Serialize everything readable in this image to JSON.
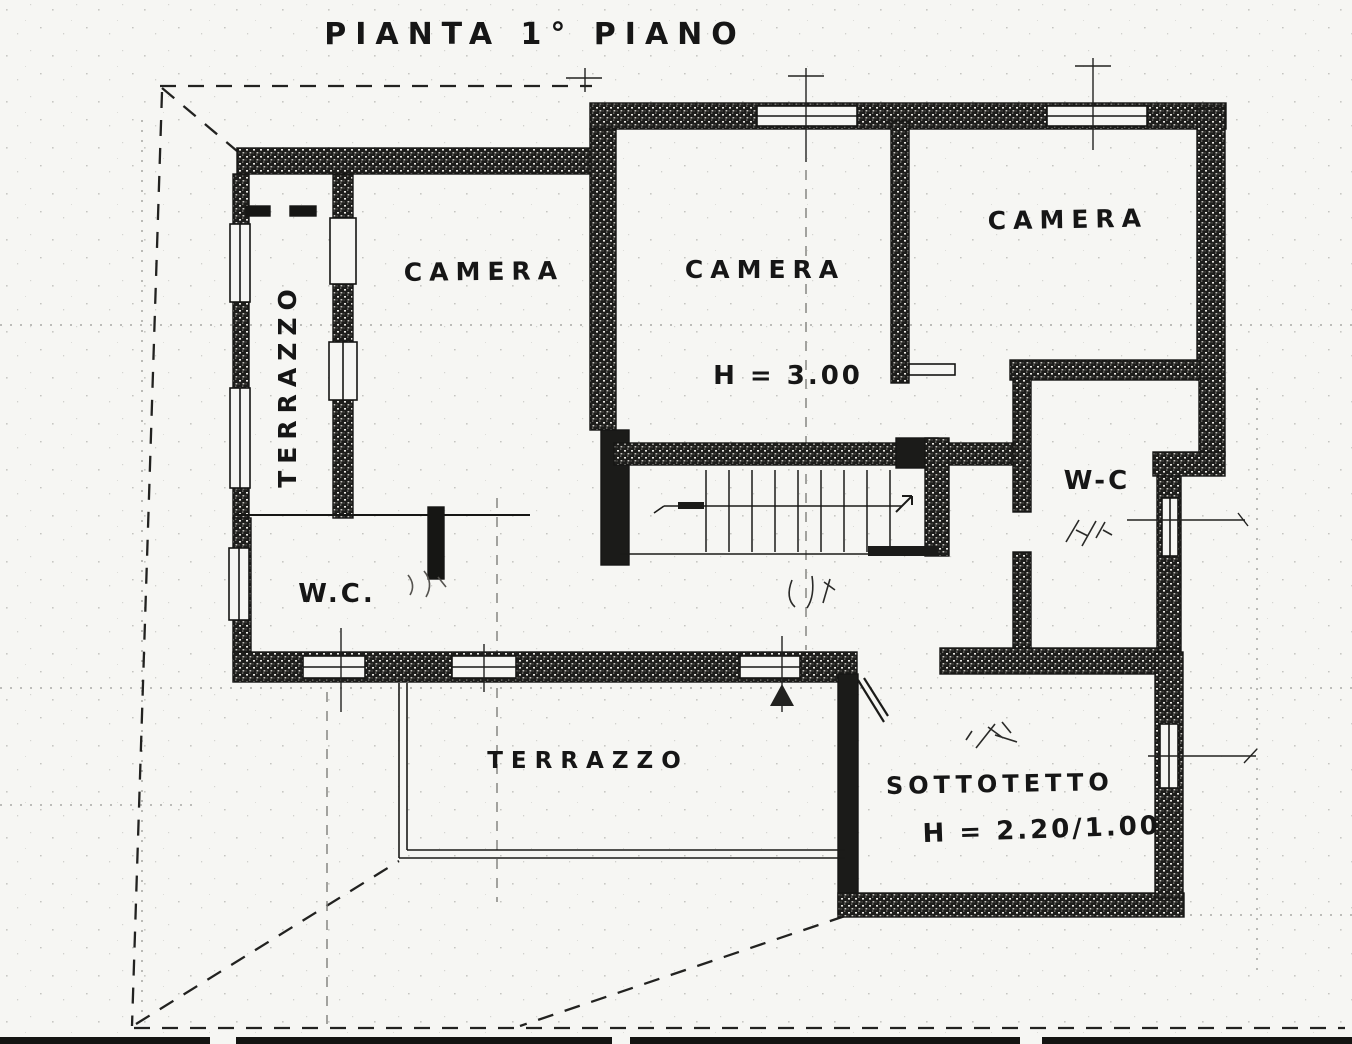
{
  "page": {
    "title": "PIANTA 1° PIANO"
  },
  "rooms": {
    "camera_left": "CAMERA",
    "camera_middle": "CAMERA",
    "camera_middle_height": "H = 3.00",
    "camera_right": "CAMERA",
    "terrazzo_left": "TERRAZZO",
    "terrazzo_bottom": "TERRAZZO",
    "wc_left": "W.C.",
    "wc_right": "W-C",
    "sottotetto": "SOTTOTETTO",
    "sottotetto_height": "H = 2.20/1.00"
  },
  "colors": {
    "ink": "#161616",
    "paper": "#f6f6f3"
  }
}
